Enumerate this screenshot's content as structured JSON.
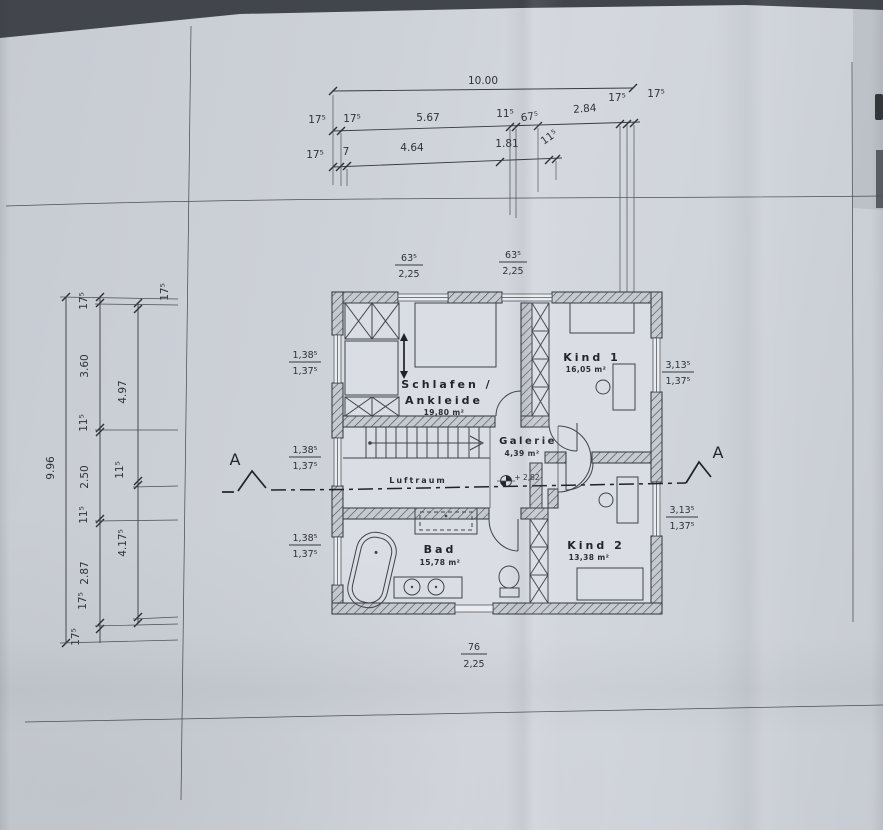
{
  "rooms": {
    "schlafen": {
      "label_line1": "Schlafen /",
      "label_line2": "Ankleide",
      "area": "19,80 m²"
    },
    "kind1": {
      "label": "Kind 1",
      "area": "16,05 m²"
    },
    "kind2": {
      "label": "Kind 2",
      "area": "13,38 m²"
    },
    "bad": {
      "label": "Bad",
      "area": "15,78 m²"
    },
    "galerie": {
      "label": "Galerie",
      "area": "4,39 m²"
    },
    "luftraum": {
      "label": "Luftraum"
    }
  },
  "annotations": {
    "level_marker": "+ 2,82",
    "section_left": "A",
    "section_right": "A"
  },
  "dims": {
    "top": {
      "total": "10.00",
      "row2": [
        "17⁵",
        "17⁵",
        "5.67",
        "11⁵",
        "67⁵",
        "2.84",
        "17⁵",
        "17⁵"
      ],
      "row3": [
        "17⁵",
        "7",
        "4.64",
        "1.81",
        "11⁵"
      ]
    },
    "left": {
      "total": "9.96",
      "chain_b": [
        "17⁵",
        "3.60",
        "11⁵",
        "2.50",
        "11⁵",
        "2.87",
        "17⁵",
        "17⁵"
      ],
      "chain_c": [
        "17⁵",
        "4.97",
        "11⁵",
        "4.17⁵"
      ]
    },
    "windows": {
      "top": [
        {
          "w": "63⁵",
          "h": "2,25"
        },
        {
          "w": "63⁵",
          "h": "2,25"
        }
      ],
      "left": [
        {
          "w": "1,38⁵",
          "h": "1,37⁵"
        },
        {
          "w": "1,38⁵",
          "h": "1,37⁵"
        },
        {
          "w": "1,38⁵",
          "h": "1,37⁵"
        }
      ],
      "right": [
        {
          "w": "3,13⁵",
          "h": "1,37⁵"
        },
        {
          "w": "3,13⁵",
          "h": "1,37⁵"
        }
      ],
      "bottom": [
        {
          "w": "76",
          "h": "2,25"
        }
      ]
    }
  }
}
